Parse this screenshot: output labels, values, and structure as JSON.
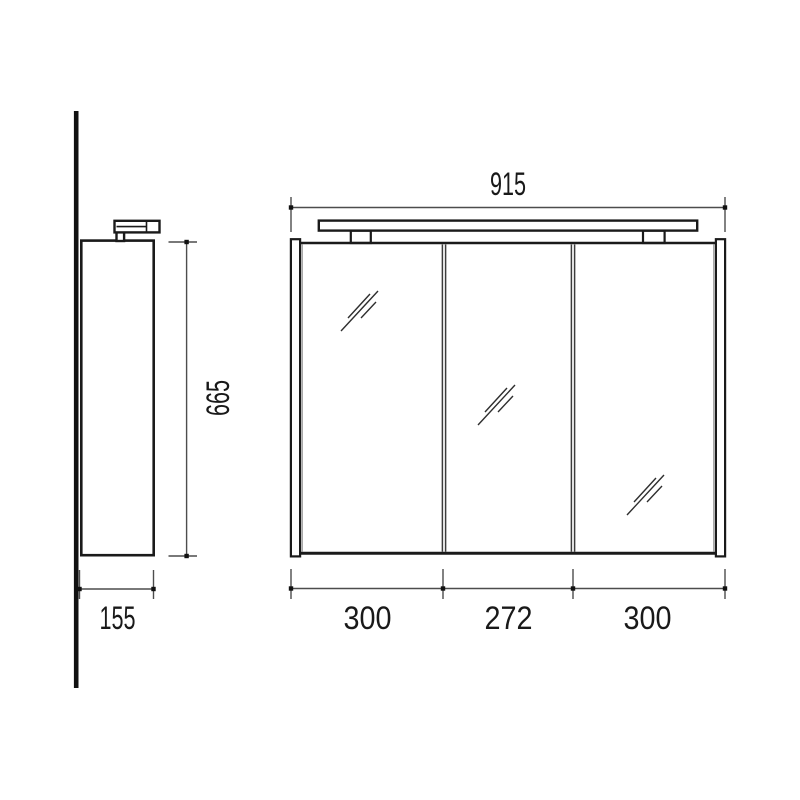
{
  "colors": {
    "line": "#1a1a1a",
    "dimension_line": "#4d4d4d",
    "text": "#191919",
    "background": "#ffffff"
  },
  "icons": {
    "mirror_glass": "diagonal-reflection-slashes"
  },
  "side_view": {
    "height_label": "665",
    "depth_label": "155"
  },
  "front_view": {
    "overall_width_label": "915",
    "door_width_labels": [
      "300",
      "272",
      "300"
    ]
  }
}
